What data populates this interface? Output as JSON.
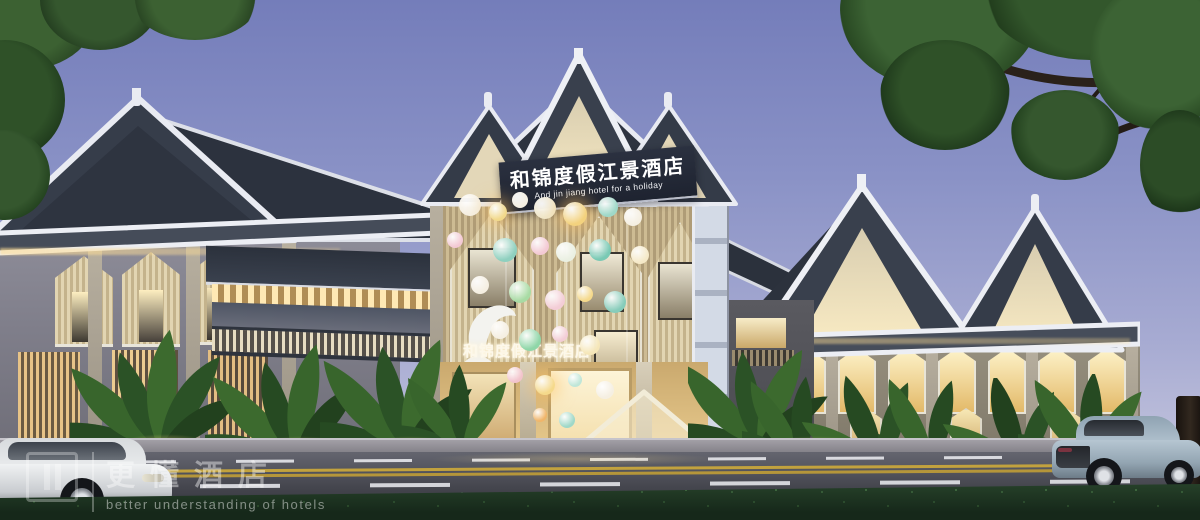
{
  "signs": {
    "main": {
      "cn": "和锦度假江景酒店",
      "en": "And jin jiang hotel for a holiday"
    },
    "entrance": {
      "cn": "和锦度假江景酒店"
    }
  },
  "watermark": {
    "cn": "更懂酒店",
    "en": "better understanding of hotels"
  },
  "palette": {
    "sky_top": "#747dba",
    "sky_horizon": "#cfcfe2",
    "roof_dark": "#333a47",
    "roof_trim": "#eceef4",
    "gable_panel": "#ecdfc0",
    "facade_wood": "#c9b691",
    "warm_light": "#f7e2a8",
    "road": "#4a4c55",
    "lane_yellow": "#c2a23e",
    "hedge": "#1e3020",
    "foliage": "#35572e",
    "sign_bg": "#232833",
    "sign_text": "#ffffff"
  },
  "balloons": [
    {
      "x": 470,
      "y": 205,
      "r": 11,
      "c": "#f5efe2"
    },
    {
      "x": 498,
      "y": 212,
      "r": 9,
      "c": "#f2d98b",
      "g": 1
    },
    {
      "x": 520,
      "y": 200,
      "r": 8,
      "c": "#f5efe2"
    },
    {
      "x": 545,
      "y": 208,
      "r": 11,
      "c": "#f0e6c8"
    },
    {
      "x": 575,
      "y": 214,
      "r": 12,
      "c": "#f3d27e",
      "g": 1
    },
    {
      "x": 608,
      "y": 207,
      "r": 10,
      "c": "#9fd8c8"
    },
    {
      "x": 633,
      "y": 217,
      "r": 9,
      "c": "#f5efe2"
    },
    {
      "x": 455,
      "y": 240,
      "r": 8,
      "c": "#f3c9d4"
    },
    {
      "x": 505,
      "y": 250,
      "r": 12,
      "c": "#8fd0bf"
    },
    {
      "x": 540,
      "y": 246,
      "r": 9,
      "c": "#f3c9d4"
    },
    {
      "x": 566,
      "y": 252,
      "r": 10,
      "c": "#eaf0e2"
    },
    {
      "x": 600,
      "y": 250,
      "r": 11,
      "c": "#79c9b4"
    },
    {
      "x": 640,
      "y": 255,
      "r": 9,
      "c": "#f5e9c8"
    },
    {
      "x": 480,
      "y": 285,
      "r": 9,
      "c": "#f5efe2"
    },
    {
      "x": 520,
      "y": 292,
      "r": 11,
      "c": "#a8dba4"
    },
    {
      "x": 555,
      "y": 300,
      "r": 10,
      "c": "#f3cdd6"
    },
    {
      "x": 585,
      "y": 294,
      "r": 8,
      "c": "#f5d98b"
    },
    {
      "x": 615,
      "y": 302,
      "r": 11,
      "c": "#86ccba"
    },
    {
      "x": 500,
      "y": 330,
      "r": 9,
      "c": "#f5efe2"
    },
    {
      "x": 530,
      "y": 340,
      "r": 11,
      "c": "#8fd6a8"
    },
    {
      "x": 560,
      "y": 334,
      "r": 8,
      "c": "#f3cdd6"
    },
    {
      "x": 590,
      "y": 345,
      "r": 10,
      "c": "#f5e6b8"
    },
    {
      "x": 515,
      "y": 375,
      "r": 8,
      "c": "#f2c4cf"
    },
    {
      "x": 545,
      "y": 385,
      "r": 10,
      "c": "#f5d98b",
      "g": 1
    },
    {
      "x": 575,
      "y": 380,
      "r": 7,
      "c": "#bfe6d8"
    },
    {
      "x": 605,
      "y": 390,
      "r": 9,
      "c": "#f5efe2"
    },
    {
      "x": 540,
      "y": 415,
      "r": 7,
      "c": "#f0b56a"
    },
    {
      "x": 567,
      "y": 420,
      "r": 8,
      "c": "#9fd8c8"
    }
  ]
}
